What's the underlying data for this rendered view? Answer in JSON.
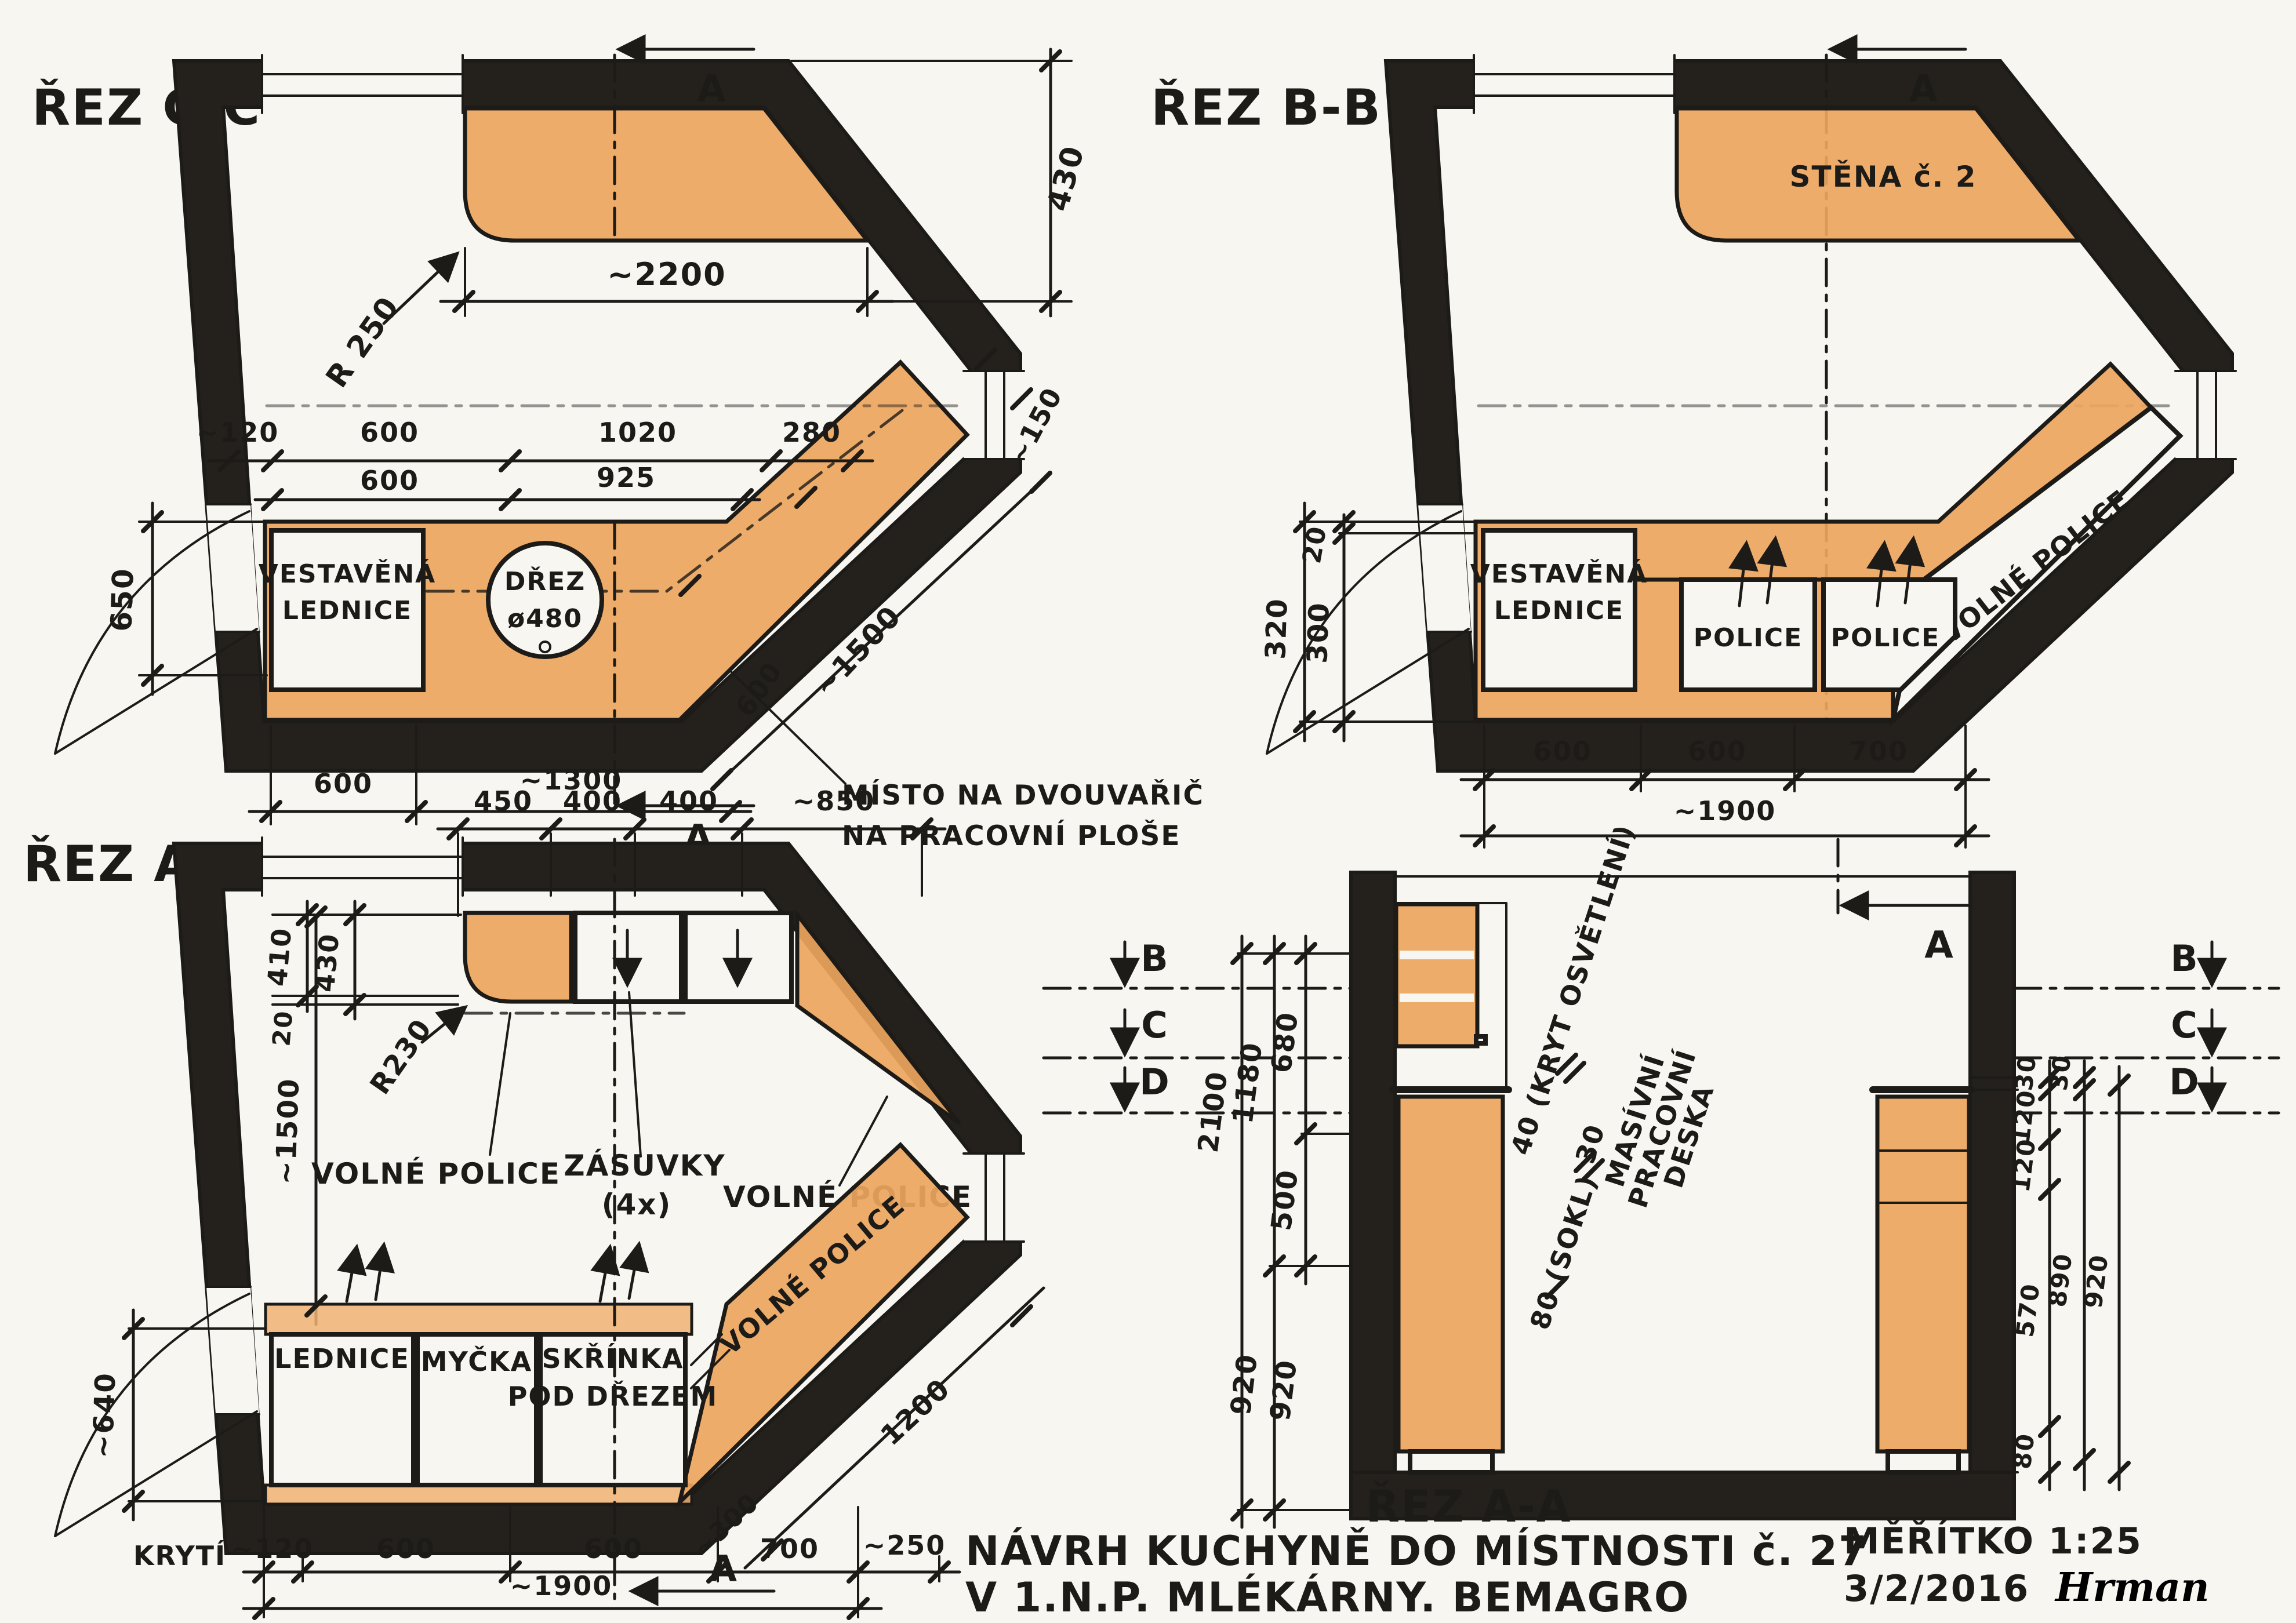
{
  "drawing_type": "hand-drawn kitchen design plan, pencil on paper, Czech",
  "colors": {
    "paper": "#f8f6f1",
    "ink": "#1d1b18",
    "wall_fill": "#24211d",
    "counter_orange": "#eda55e"
  },
  "plan_cc": {
    "label": "ŘEZ C-C",
    "section_marker": "A",
    "dim_top_counter": "~2200",
    "dim_430": "430",
    "radius": "R 250",
    "dim_120": "~120",
    "dim_600a": "600",
    "dim_1020": "1020",
    "dim_280": "280",
    "dim_600b": "600",
    "dim_925": "925",
    "dim_650": "650",
    "dim_600_bottom": "600",
    "dim_1300": "~1300",
    "dim_1500": "~1500",
    "dim_150": "~150",
    "dim_600_diag": "600",
    "fridge_line1": "VESTAVĚNÁ",
    "fridge_line2": "LEDNICE",
    "sink_line1": "DŘEZ",
    "sink_line2": "ø480",
    "note_line1": "MÍSTO NA DVOUVAŘIČ",
    "note_line2": "NA PRACOVNÍ PLOŠE"
  },
  "plan_bb": {
    "label": "ŘEZ B-B",
    "section_marker": "A",
    "wall_note": "STĚNA č. 2",
    "fridge_line1": "VESTAVĚNÁ",
    "fridge_line2": "LEDNICE",
    "shelf1": "POLICE",
    "shelf2": "POLICE",
    "free_shelves": "VOLNÉ POLICE",
    "dim_320": "320",
    "dim_300": "300",
    "dim_20": "20",
    "dim_600a": "600",
    "dim_600b": "600",
    "dim_700": "700",
    "dim_1900": "~1900"
  },
  "plan_aa": {
    "label": "ŘEZ A-A",
    "section_marker": "A",
    "dim_450": "450",
    "dim_400a": "400",
    "dim_400b": "400",
    "dim_850": "~850",
    "dim_410": "410",
    "dim_430": "430",
    "dim_20": "20",
    "radius": "R230",
    "free_shelves_left": "VOLNÉ POLICE",
    "drawers_line1": "ZÁSUVKY",
    "drawers_line2": "(4x)",
    "free_shelves_right": "VOLNÉ POLICE",
    "dim_1500": "~1500",
    "dim_640": "~640",
    "fridge": "LEDNICE",
    "dishwasher": "MYČKA",
    "sink_cab_line1": "SKŘÍNKA",
    "sink_cab_line2": "POD DŘEZEM",
    "free_shelves_diag": "VOLNÉ POLICE",
    "dim_1200": "1200",
    "dim_300": "~300",
    "cover_label": "KRYTÍ",
    "dim_120": "~120",
    "dim_600a": "600",
    "dim_600b": "600",
    "dim_700": "700",
    "dim_1900": "~1900",
    "dim_250": "~250"
  },
  "section_aa": {
    "label": "ŘEZ A-A",
    "section_marker": "A",
    "marker_b": "B",
    "marker_c": "C",
    "marker_d": "D",
    "dim_680": "680",
    "dim_1180": "1180",
    "dim_500": "500",
    "dim_2100": "2100",
    "dim_920a": "920",
    "dim_920b": "920",
    "note_40": "40 (KRYT OSVĚTLENÍ)",
    "note_30": "30",
    "note_material_1": "MASÍVNÍ",
    "note_material_2": "PRACOVNÍ",
    "note_material_3": "DESKA",
    "note_80": "80 (SOKL)",
    "dim_30a": "30",
    "dim_120a": "120",
    "dim_120b": "120",
    "dim_570": "570",
    "dim_80": "80",
    "dim_30b": "30",
    "dim_890": "890",
    "dim_920c": "920"
  },
  "titleblock": {
    "title_line1": "NÁVRH KUCHYNĚ DO MÍSTNOSTI č. 27",
    "title_line2": "V 1.N.P. MLÉKÁRNY. BEMAGRO",
    "scale": "MĚŘÍTKO 1:25",
    "date": "3/2/2016",
    "signature": "Hrman"
  }
}
